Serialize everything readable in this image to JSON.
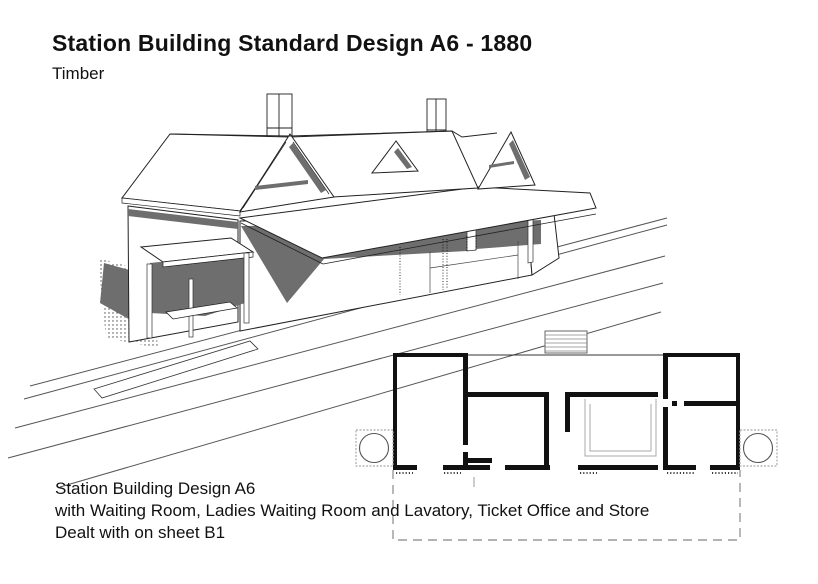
{
  "header": {
    "title": "Station Building Standard Design A6 - 1880",
    "subtitle": "Timber"
  },
  "caption": {
    "lines": {
      "0": "Station Building Design A6",
      "1": "with Waiting Room, Ladies Waiting Room and Lavatory, Ticket Office and Store",
      "2": "Dealt with on sheet B1"
    }
  },
  "figure": {
    "colors": {
      "background": "#ffffff",
      "linework": "#1a1a1a",
      "shadow_gray": "#6e6e6e",
      "plan_wall_black": "#111111",
      "plan_dashed_gray": "#999999"
    }
  }
}
